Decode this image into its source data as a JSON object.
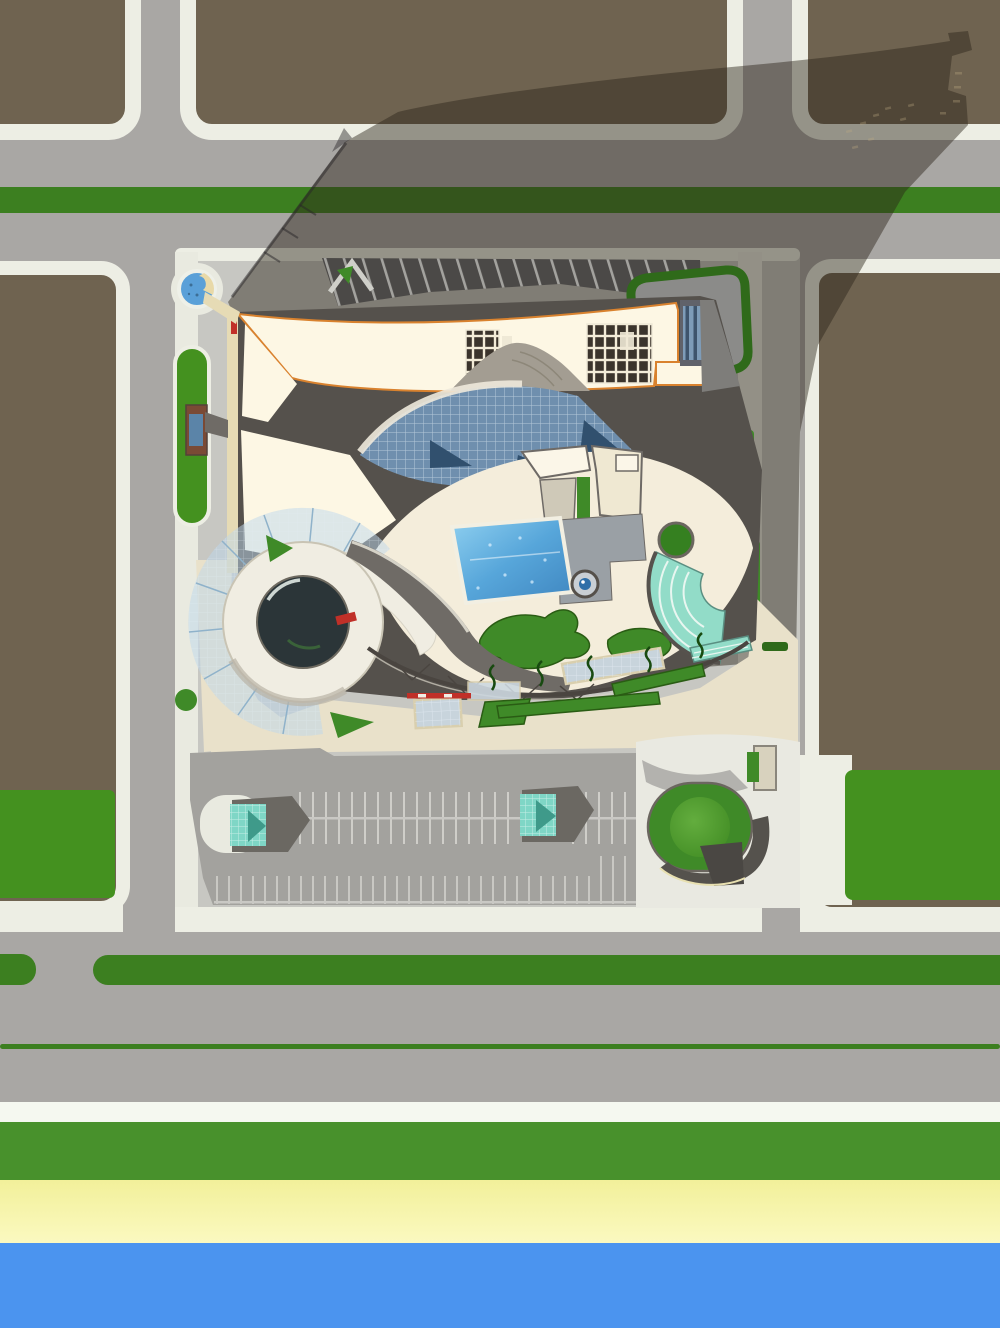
{
  "scene": {
    "type": "aerial-architectural-site-plan",
    "view": "top-down",
    "subject": "leisure-center with curved crescent roof, glass atrium, spiral dome pavilion, pool courtyard, amphitheater, parking lot, roundabout, beachfront"
  },
  "palette": {
    "road_gray": "#a9a7a4",
    "parcel_brown": "#6f6350",
    "curb_white": "#edeee4",
    "sidewalk_white": "#e9eae0",
    "plaza_gray": "#c7c7c2",
    "plaza_cream": "#e9e1ca",
    "median_green": "#3c7f20",
    "grass_green": "#44911f",
    "lawn_green": "#3f8a28",
    "hedge_green": "#2f6a1a",
    "hedge_dark": "#2a5c14",
    "roof_cream": "#fdf7e4",
    "roof_edge_orange": "#d9822e",
    "roof_dark": "#55514c",
    "roof_mid_gray": "#7e7d7a",
    "wall_beige": "#e6dbb5",
    "glass_blue": "#6f8fae",
    "glass_navy": "#31506e",
    "pool_blue": "#57a6da",
    "water_blue": "#5aa0d8",
    "dome_dark": "#2b3538",
    "wireframe_blue": "#8fb2ca",
    "wireframe_fill": "rgba(190,215,235,0.5)",
    "amphitheater_teal": "#92dcc8",
    "kiosk_teal": "#7fd6c6",
    "shadow_dark": "rgba(42,35,25,0.45)",
    "stripe_white": "#cfcec9",
    "sand_yellow": "#f6f4a4",
    "sea_blue": "#4b94ef",
    "band_green": "#48912c",
    "band_white": "#f5f8f0",
    "accent_red": "#c03028",
    "shadow_band_dark": "#4b4947",
    "island_green": "#4f9c30"
  },
  "layout_counts": {
    "top_parcels": 3,
    "parking_rows": 2,
    "parking_kiosks": 2,
    "skylight_grid_a": "3x5",
    "skylight_grid_b": "6x5"
  }
}
